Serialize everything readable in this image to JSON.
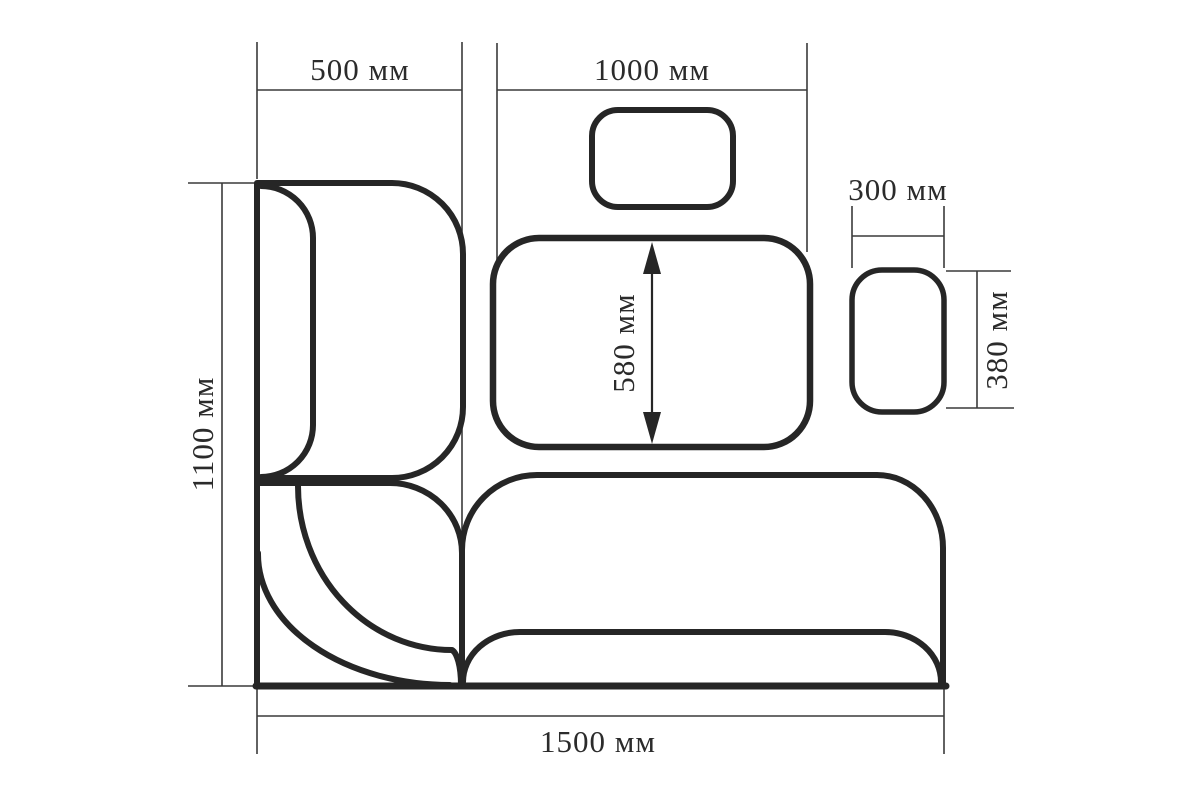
{
  "drawing": {
    "type": "furniture-dimension-diagram",
    "unit": "мм",
    "dimensions": [
      {
        "name": "left-section-width",
        "value": 500,
        "unit": "мм",
        "label": "500 мм",
        "orientation": "horizontal"
      },
      {
        "name": "main-section-width",
        "value": 1000,
        "unit": "мм",
        "label": "1000 мм",
        "orientation": "horizontal"
      },
      {
        "name": "overall-height",
        "value": 1100,
        "unit": "мм",
        "label": "1100 мм",
        "orientation": "vertical"
      },
      {
        "name": "overall-length",
        "value": 1500,
        "unit": "мм",
        "label": "1500 мм",
        "orientation": "horizontal"
      },
      {
        "name": "backrest-panel-height",
        "value": 580,
        "unit": "мм",
        "label": "580 мм",
        "orientation": "vertical"
      },
      {
        "name": "side-module-width",
        "value": 300,
        "unit": "мм",
        "label": "300 мм",
        "orientation": "horizontal"
      },
      {
        "name": "side-module-height",
        "value": 380,
        "unit": "мм",
        "label": "380 мм",
        "orientation": "vertical"
      }
    ],
    "colors": {
      "outline": "#262626",
      "dimension_lines": "#3a3a3a",
      "text": "#2b2b2b",
      "background": "#ffffff"
    }
  }
}
